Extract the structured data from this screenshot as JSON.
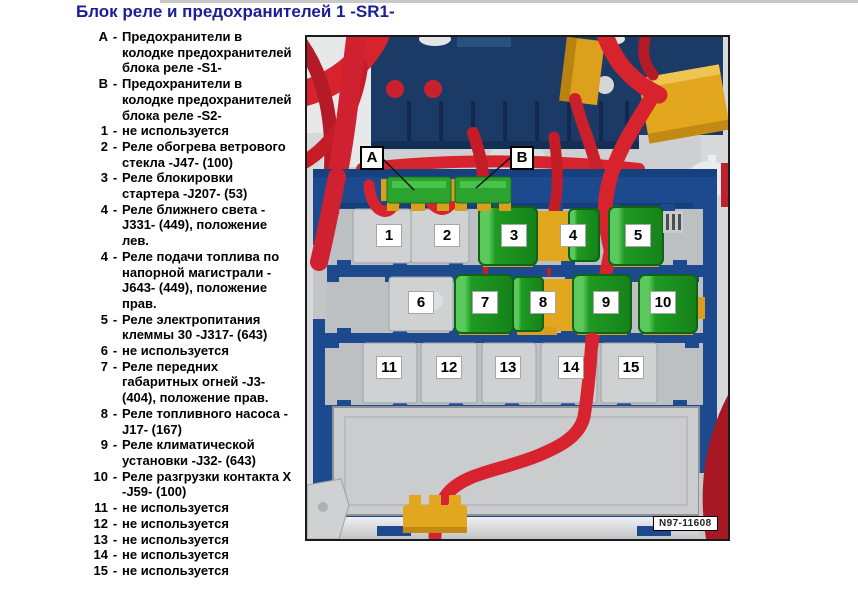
{
  "title": "Блок реле и предохранителей 1 -SR1-",
  "legend": {
    "separator": "-",
    "items": [
      {
        "key": "A",
        "text": "Предохранители в колодке предохранителей блока реле -S1-"
      },
      {
        "key": "B",
        "text": "Предохранители в колодке предохранителей блока реле -S2-"
      },
      {
        "key": "1",
        "text": "не используется"
      },
      {
        "key": "2",
        "text": "Реле обогрева ветрового стекла -J47- (100)"
      },
      {
        "key": "3",
        "text": "Реле блокировки стартера -J207- (53)"
      },
      {
        "key": "4",
        "text": "Реле ближнего света - J331- (449), положение лев."
      },
      {
        "key": "4",
        "text": "Реле подачи топлива по напорной магистрали - J643- (449), положение прав."
      },
      {
        "key": "5",
        "text": "Реле электропитания клеммы 30 -J317- (643)"
      },
      {
        "key": "6",
        "text": "не используется"
      },
      {
        "key": "7",
        "text": "Реле передних габаритных огней -J3- (404), положение прав."
      },
      {
        "key": "8",
        "text": "Реле топливного насоса - J17- (167)"
      },
      {
        "key": "9",
        "text": "Реле климатической установки -J32- (643)"
      },
      {
        "key": "10",
        "text": "Реле разгрузки контакта X -J59- (100)"
      },
      {
        "key": "11",
        "text": "не используется"
      },
      {
        "key": "12",
        "text": "не используется"
      },
      {
        "key": "13",
        "text": "не используется"
      },
      {
        "key": "14",
        "text": "не используется"
      },
      {
        "key": "15",
        "text": "не используется"
      }
    ]
  },
  "diagram": {
    "callout_a": "A",
    "callout_b": "B",
    "slot_labels": [
      "1",
      "2",
      "3",
      "4",
      "5",
      "6",
      "7",
      "8",
      "9",
      "10",
      "11",
      "12",
      "13",
      "14",
      "15"
    ],
    "figure_ref": "N97-11608",
    "colors": {
      "title_blue": "#1d1d96",
      "housing_navy": "#1c3a66",
      "plate_blue": "#1d4a8f",
      "relay_green": "#1f9a22",
      "fuse_yellow": "#e2a71f",
      "wire_red": "#d6232e",
      "socket_grey": "#cfd1d3"
    }
  }
}
